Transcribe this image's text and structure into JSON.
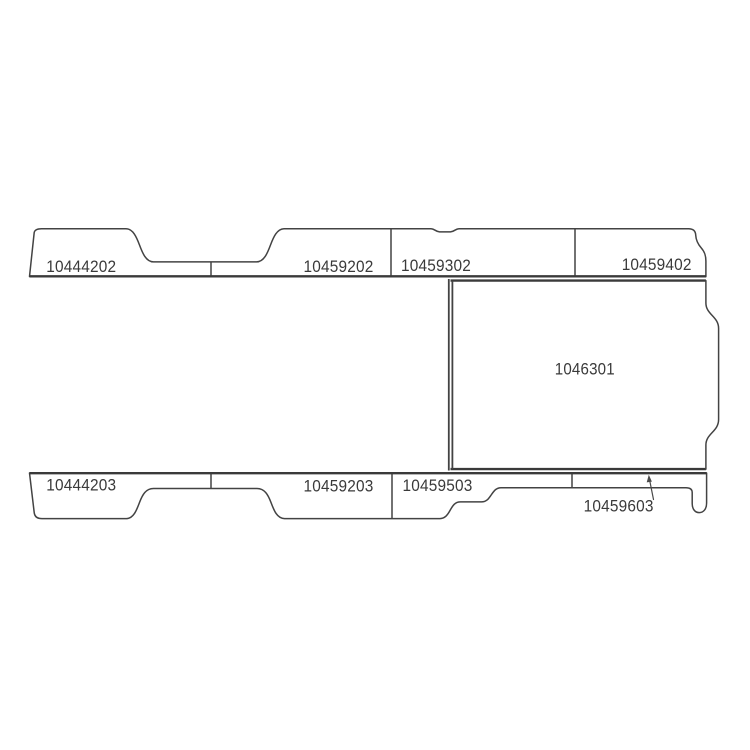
{
  "diagram": {
    "background_color": "#ffffff",
    "line_color": "#434343",
    "text_color": "#3a3a3a",
    "top_strip": {
      "sections": [
        {
          "label": "10444202"
        },
        {
          "label": "10459202"
        },
        {
          "label": "10459302"
        },
        {
          "label": "10459402"
        }
      ]
    },
    "floor_panel": {
      "label": "1046301"
    },
    "bottom_strip": {
      "sections": [
        {
          "label": "10444203"
        },
        {
          "label": "10459203"
        },
        {
          "label": "10459503"
        },
        {
          "label": "10459603"
        }
      ]
    }
  }
}
